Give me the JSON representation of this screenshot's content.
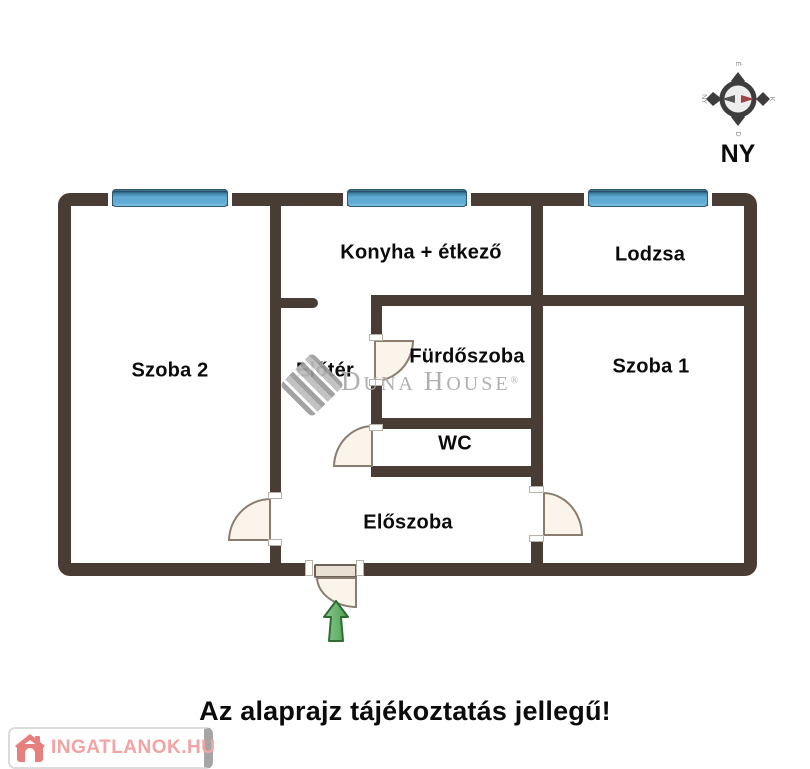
{
  "compass": {
    "label": "NY",
    "letters": {
      "n": "É",
      "e": "K",
      "s": "D",
      "w": "NY"
    }
  },
  "rooms": {
    "szoba2": "Szoba 2",
    "konyha": "Konyha + étkező",
    "lodzsa": "Lodzsa",
    "furdoszoba": "Fürdőszoba",
    "szoba1": "Szoba 1",
    "wc": "WC",
    "eloszoba": "Előszoba",
    "eloter": "Előtér"
  },
  "watermark_brand": {
    "word1_initial": "D",
    "word1_rest": "UNA",
    "word2_initial": "H",
    "word2_rest": "OUSE",
    "registered": "®"
  },
  "corner_badge": {
    "text": "INGATLANOK.HU"
  },
  "disclaimer": "Az alaprajz tájékoztatás jellegű!",
  "colors": {
    "wall": "#483C34",
    "window_blue": "#5FABD4",
    "door_fill": "#FAF4EA",
    "arrow_green": "#57A85C",
    "badge_pink": "#F2A3A3",
    "watermark_gray": "#ACACAC",
    "compass_red": "#9E4444"
  }
}
